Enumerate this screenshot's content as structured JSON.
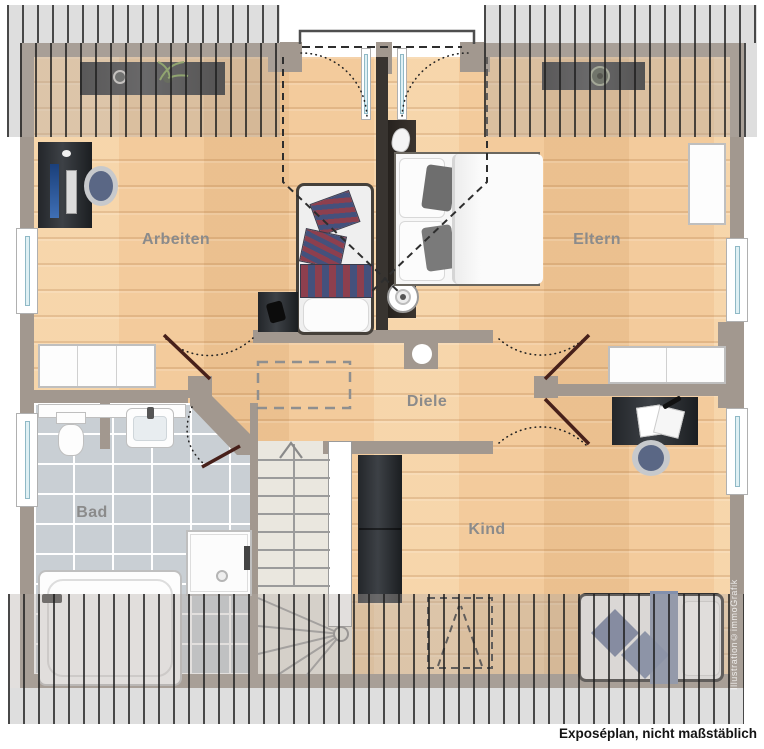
{
  "plan": {
    "caption": "Exposéplan, nicht maßstäblich",
    "watermark": "Illustration©immoGrafik",
    "rooms": [
      {
        "id": "arbeiten",
        "label": "Arbeiten"
      },
      {
        "id": "eltern",
        "label": "Eltern"
      },
      {
        "id": "diele",
        "label": "Diele"
      },
      {
        "id": "bad",
        "label": "Bad"
      },
      {
        "id": "kind",
        "label": "Kind"
      }
    ],
    "colors": {
      "wall": "#a2988f",
      "wood_floor": "#f3cb9c",
      "tile_floor": "#c9cfd4",
      "roof_hatch_bg": "#dedede",
      "door_leaf": "#47201a",
      "stripe_red": "#8d3f4e",
      "stripe_blue": "#44517c",
      "kind_textile": "#7687a8",
      "label_text": "#8b8b8b"
    }
  }
}
